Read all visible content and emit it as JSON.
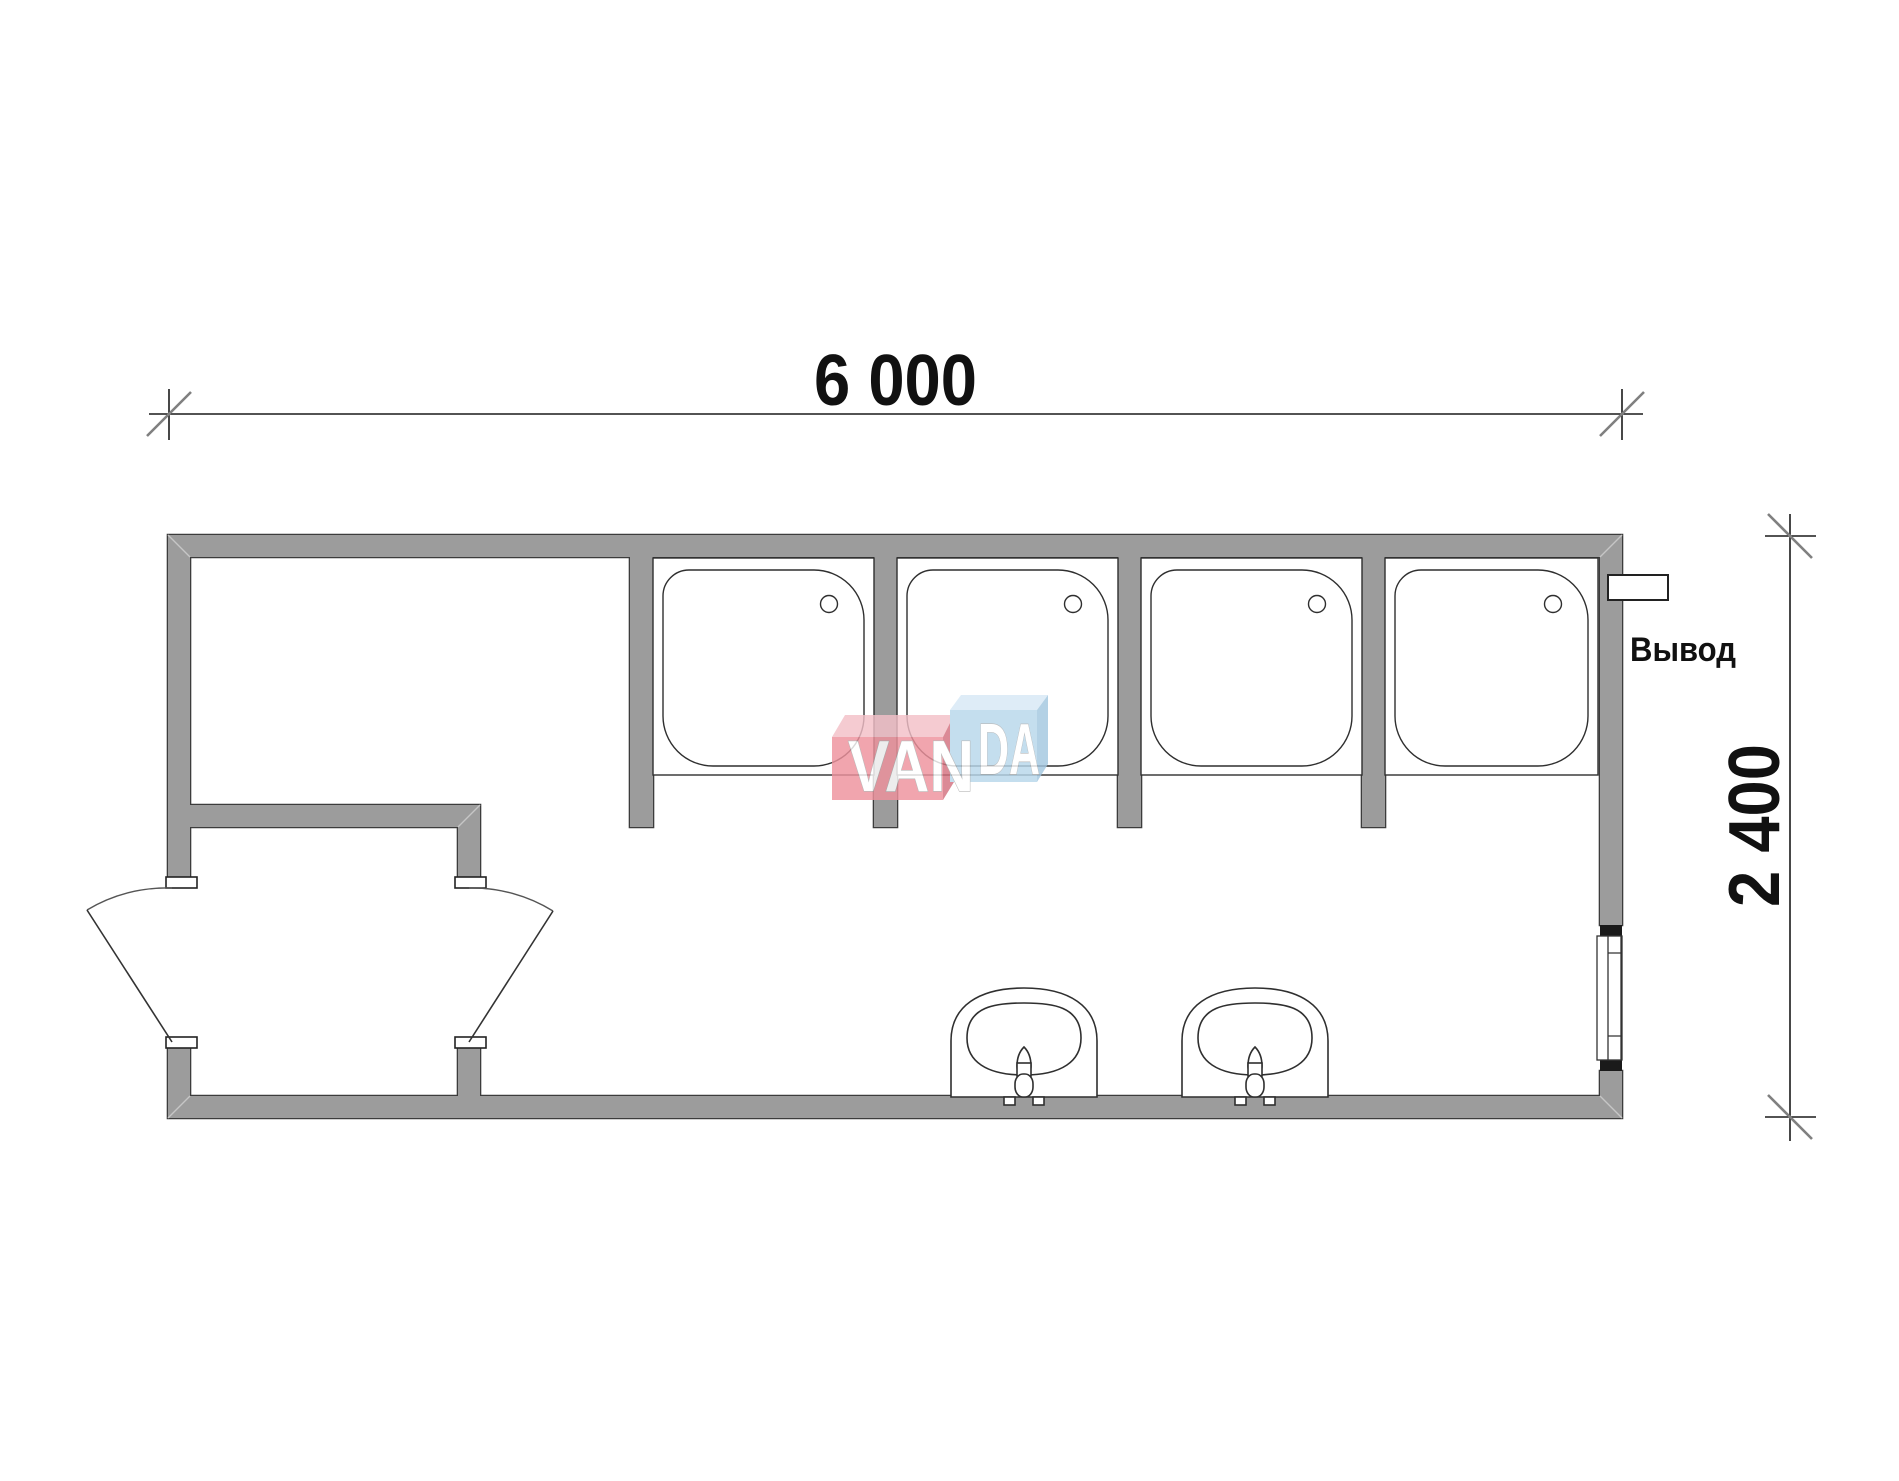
{
  "drawing": {
    "type": "modular-building-floor-plan",
    "dimensions": {
      "width_label": "6 000",
      "height_label": "2 400"
    },
    "labels": {
      "outlet": "Вывод"
    },
    "watermark": {
      "left": "VAN",
      "right": "DA"
    },
    "fixtures": {
      "shower_trays": 4,
      "washbasins": 2,
      "doors": 2,
      "windows": 1,
      "partitions": 4
    },
    "colors": {
      "background": "#ffffff",
      "wall": "#9c9c9c",
      "outline": "#3c3c3c",
      "fixture_line": "#2f2f2f",
      "dim_line": "#1a1a1a",
      "tick_slash": "#808080",
      "miter": "#c6c6c6",
      "wm_red_front": "#ee929d",
      "wm_red_top": "#f3c0c8",
      "wm_red_side": "#d4717f",
      "wm_blue_front": "#b8d7eb",
      "wm_blue_top": "#d7e9f6",
      "wm_blue_side": "#a3c7e0"
    }
  }
}
